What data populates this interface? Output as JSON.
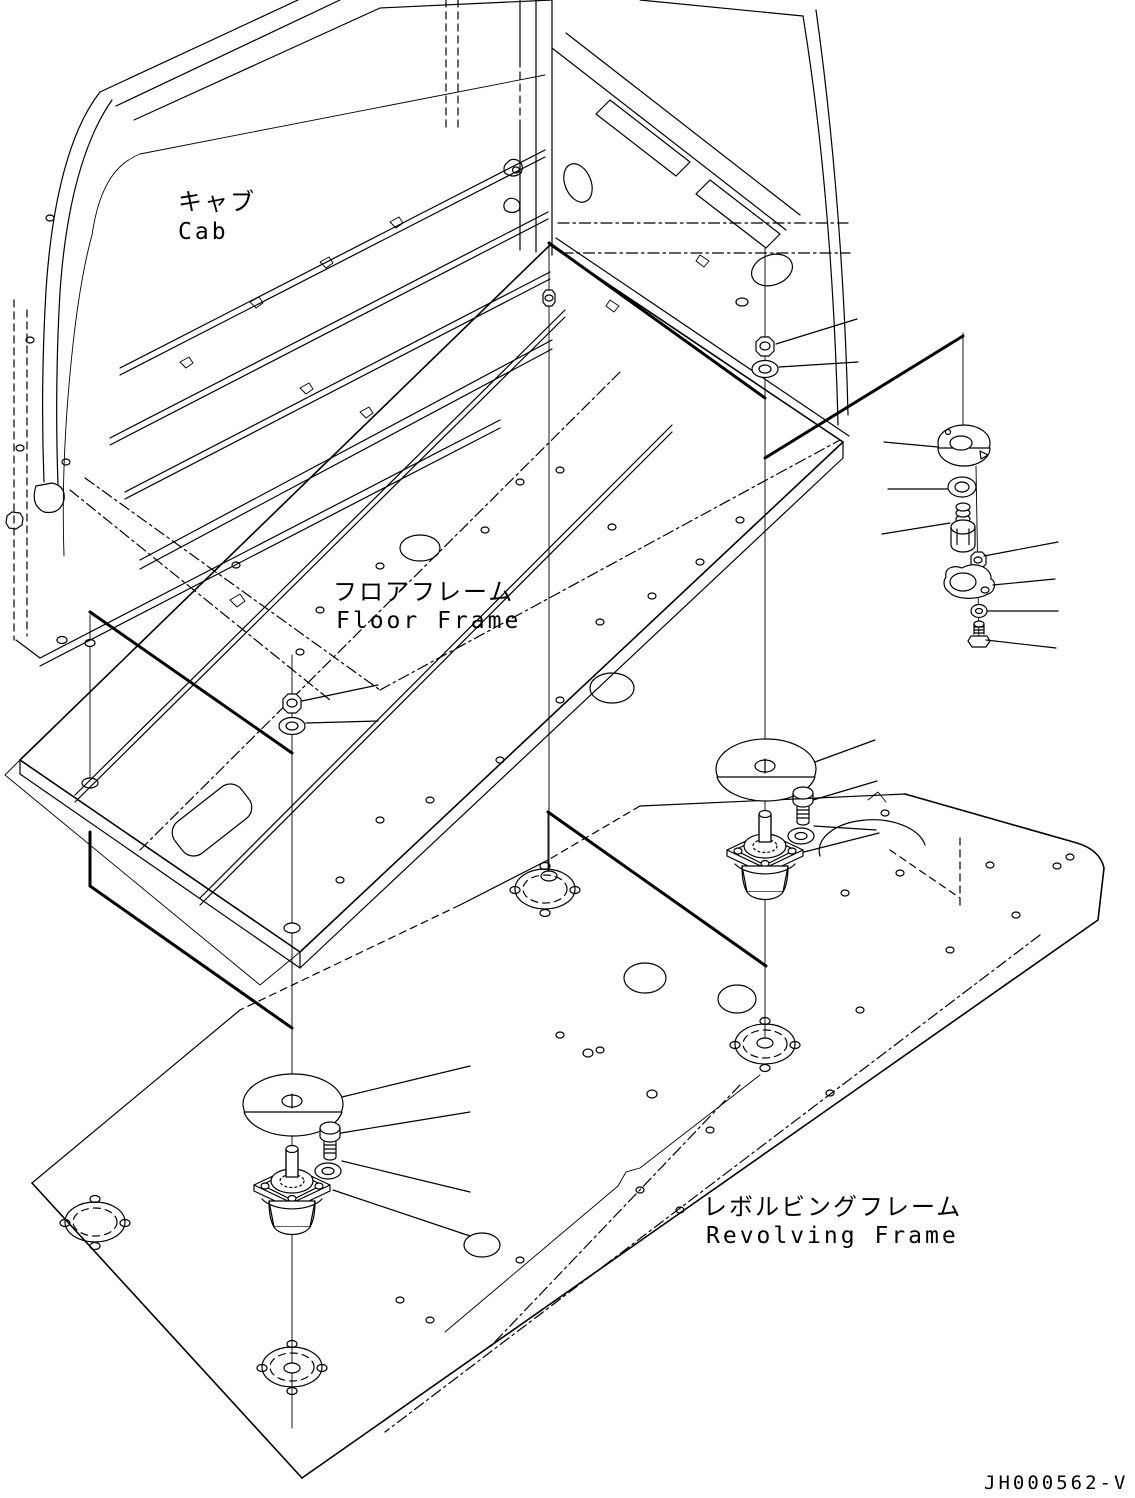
{
  "drawing": {
    "labels": {
      "cab_jp": "キャブ",
      "cab_en": "Cab",
      "floor_frame_jp": "フロアフレーム",
      "floor_frame_en": "Floor Frame",
      "revolving_frame_jp": "レボルビングフレーム",
      "revolving_frame_en": "Revolving Frame"
    },
    "drawing_number": "JH000562-V",
    "colors": {
      "line": "#000000",
      "background": "#ffffff"
    }
  }
}
